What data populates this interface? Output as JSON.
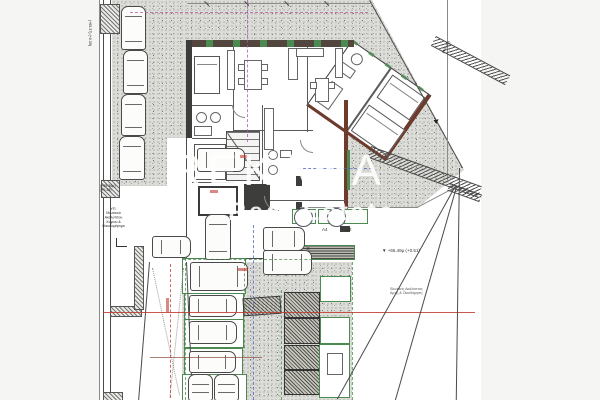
{
  "watermark": {
    "line1": "REKANA",
    "line2": "Real Estate",
    "color": "#ffffff"
  },
  "annotations": {
    "level_left_top": "(+65.37) (+0.39)",
    "level_left_mid_1": "(+65.36μ)",
    "level_left_mid_2": "(+0.38)",
    "note_left": [
      "ΥΠ.",
      "Ιδιωτικού",
      "Ακαλύπτου",
      "Χώρου &",
      "Οικοδομήσιμο"
    ],
    "level_right": "▼ +65.49μ (+0.51)",
    "level_boundary": "(+65.62)",
    "note_right_1": "Ιδιωτικός Ακάλυπτος",
    "note_right_2": "Αρχή & Οικοδόμηση",
    "court_label_a4": "Α4",
    "court_label_a2": "Α2",
    "x_marker": "×"
  },
  "palette": {
    "stipple_bg": "#dcdcd8",
    "wall_dark": "#3d3d3b",
    "wall_brown": "#6e3a2c",
    "green": "#4c8a52",
    "red": "#c03a2e",
    "magenta": "#b3529e",
    "blue": "#4a5fc0"
  }
}
